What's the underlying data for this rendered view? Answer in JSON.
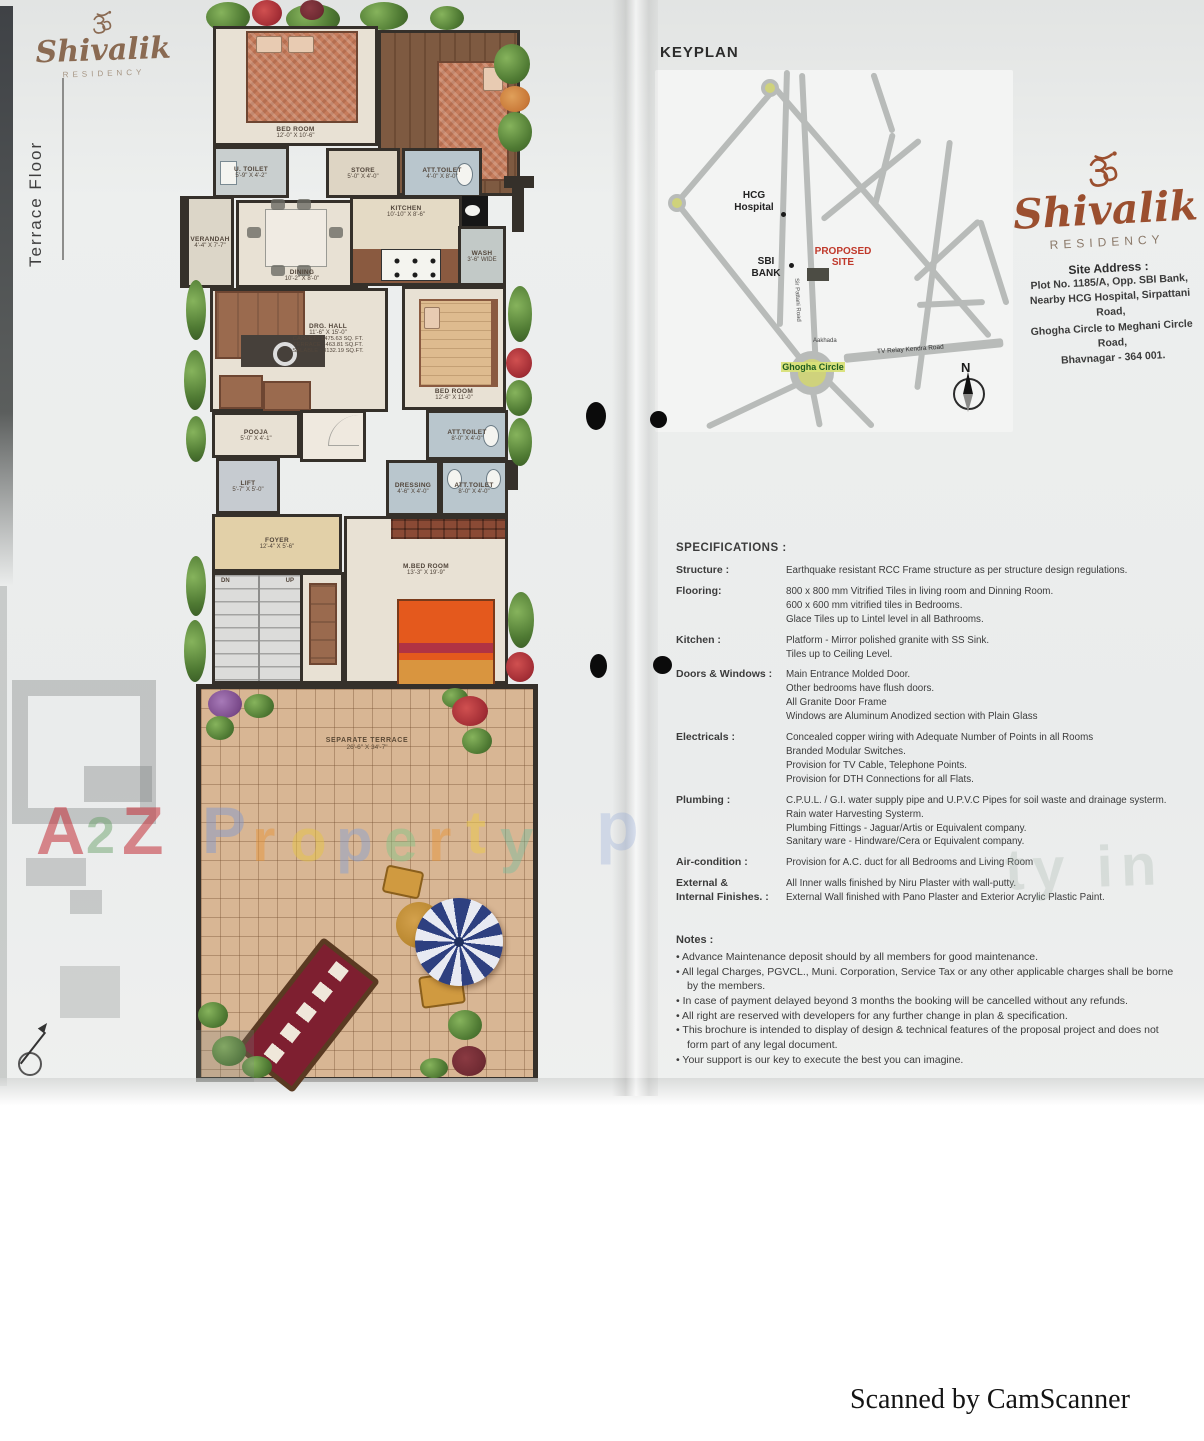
{
  "brand": {
    "name": "Shivalik",
    "residency": "RESIDENCY"
  },
  "left_page": {
    "floor_label": "Terrace  Floor",
    "plan": {
      "rooms": {
        "bedroom_top": {
          "name": "BED ROOM",
          "dims": "12'-0\" X 10'-6\""
        },
        "u_toilet": {
          "name": "U. TOILET",
          "dims": "5'-9\" X 4'-2\""
        },
        "store": {
          "name": "STORE",
          "dims": "5'-0\" X 4'-0\""
        },
        "att_toilet_top": {
          "name": "ATT.TOILET",
          "dims": "4'-0\" X 8'-0\""
        },
        "verandah": {
          "name": "VERANDAH",
          "dims": "4'-4\" X 7'-7\""
        },
        "dining": {
          "name": "DINING",
          "dims": "10'-2\" X 8'-0\""
        },
        "kitchen": {
          "name": "KITCHEN",
          "dims": "10'-10\" X 8'-6\""
        },
        "wash": {
          "name": "WASH",
          "dims": "3'-6\" WIDE"
        },
        "drg_hall": {
          "name": "DRG. HALL",
          "dims": "11'-6\" X 15'-0\"",
          "carpet": "CARPET : 1475.63 SQ. FT.",
          "terrace": "TERRACE : 463.81 SQ.FT.",
          "salable": "SALABLE : 3132.19 SQ.FT."
        },
        "bedroom_right": {
          "name": "BED ROOM",
          "dims": "12'-6\" X 11'-0\""
        },
        "att_toilet_mid": {
          "name": "ATT.TOILET",
          "dims": "8'-0\" X 4'-0\""
        },
        "pooja": {
          "name": "POOJA",
          "dims": "5'-0\" X 4'-1\""
        },
        "lift": {
          "name": "LIFT",
          "dims": "5'-7\" X 5'-0\""
        },
        "foyer": {
          "name": "FOYER",
          "dims": "12'-4\" X 5'-6\""
        },
        "stairs": {
          "dn": "DN",
          "up": "UP"
        },
        "dressing": {
          "name": "DRESSING",
          "dims": "4'-6\" X 4'-0\""
        },
        "att_toilet_low": {
          "name": "ATT.TOILET",
          "dims": "8'-0\" X 4'-0\""
        },
        "m_bedroom": {
          "name": "M.BED ROOM",
          "dims": "13'-3\" X 19'-9\""
        },
        "terrace": {
          "name": "SEPARATE TERRACE",
          "dims": "26'-6\" X 34'-7\""
        }
      }
    },
    "watermark": {
      "a": "A",
      "two": "2",
      "z": "Z",
      "property_letters": [
        "P",
        "r",
        "o",
        "p",
        "e",
        "r",
        "t",
        "y"
      ],
      "faint_right": "ty in"
    }
  },
  "right_page": {
    "keyplan": {
      "title": "KEYPLAN",
      "labels": {
        "hcg": "HCG Hospital",
        "sbi": "SBI BANK",
        "proposed": "PROPOSED SITE",
        "ghogha": "Ghogha Circle",
        "sir_pattani": "Sir Pattani Road",
        "aakhada": "Aakhada",
        "tv_relay": "TV Relay Kendra Road",
        "north": "N"
      }
    },
    "address": {
      "title": "Site Address :",
      "lines": [
        "Plot No. 1185/A, Opp. SBI Bank,",
        "Nearby HCG Hospital, Sirpattani Road,",
        "Ghogha Circle to Meghani Circle Road,",
        "Bhavnagar - 364 001."
      ]
    },
    "specifications": {
      "title": "SPECIFICATIONS :",
      "rows": [
        {
          "label": "Structure :",
          "lines": [
            "Earthquake resistant RCC Frame structure as per structure design regulations."
          ]
        },
        {
          "label": "Flooring:",
          "lines": [
            "800 x 800 mm Vitrified Tiles in living room and Dinning Room.",
            "600 x 600 mm vitrified tiles in Bedrooms.",
            "Glace Tiles up to Lintel level in all Bathrooms."
          ]
        },
        {
          "label": "Kitchen :",
          "lines": [
            "Platform - Mirror polished granite with SS Sink.",
            "Tiles up to Ceiling Level."
          ]
        },
        {
          "label": "Doors & Windows :",
          "lines": [
            "Main Entrance Molded Door.",
            "Other bedrooms have flush doors.",
            "All Granite Door Frame",
            "Windows are Aluminum Anodized section with Plain Glass"
          ]
        },
        {
          "label": "Electricals :",
          "lines": [
            "Concealed copper wiring with Adequate Number of Points in all Rooms",
            "Branded Modular Switches.",
            "Provision for TV Cable, Telephone Points.",
            "Provision for DTH Connections for all Flats."
          ]
        },
        {
          "label": "Plumbing :",
          "lines": [
            "C.P.U.L. / G.I. water supply pipe and U.P.V.C Pipes for soil waste and drainage systerm.",
            "Rain water Harvesting Systerm.",
            "Plumbing Fittings - Jaguar/Artis or Equivalent company.",
            "Sanitary ware - Hindware/Cera or Equivalent company."
          ]
        },
        {
          "label": "Air-condition :",
          "lines": [
            "Provision for A.C. duct for all Bedrooms and Living Room"
          ]
        },
        {
          "label": "External &",
          "label2": "Internal Finishes. :",
          "lines": [
            "All Inner walls finished by Niru Plaster with wall-putty.",
            "External Wall finished with Pano Plaster and Exterior  Acrylic Plastic Paint."
          ]
        }
      ]
    },
    "notes": {
      "title": "Notes :",
      "items": [
        "Advance Maintenance deposit should by all members for good maintenance.",
        "All legal Charges, PGVCL., Muni. Corporation, Service Tax or any other applicable charges shall be borne by the members.",
        "In case of payment delayed beyond 3 months the booking will be cancelled without any refunds.",
        "All right are reserved with developers for any further change in plan & specification.",
        "This brochure is intended to display of design & technical features of the proposal project and does not form part of any legal document.",
        "Your support is our key to execute the best you can imagine."
      ]
    }
  },
  "footer": {
    "scanned": "Scanned by CamScanner"
  },
  "colors": {
    "brand_brown": "#9b4f2f",
    "proposed_red": "#c0392b",
    "ghogha_green": "#1d5c1f",
    "ghogha_highlight": "#d8e078",
    "road_gray": "#b8bbb9"
  }
}
